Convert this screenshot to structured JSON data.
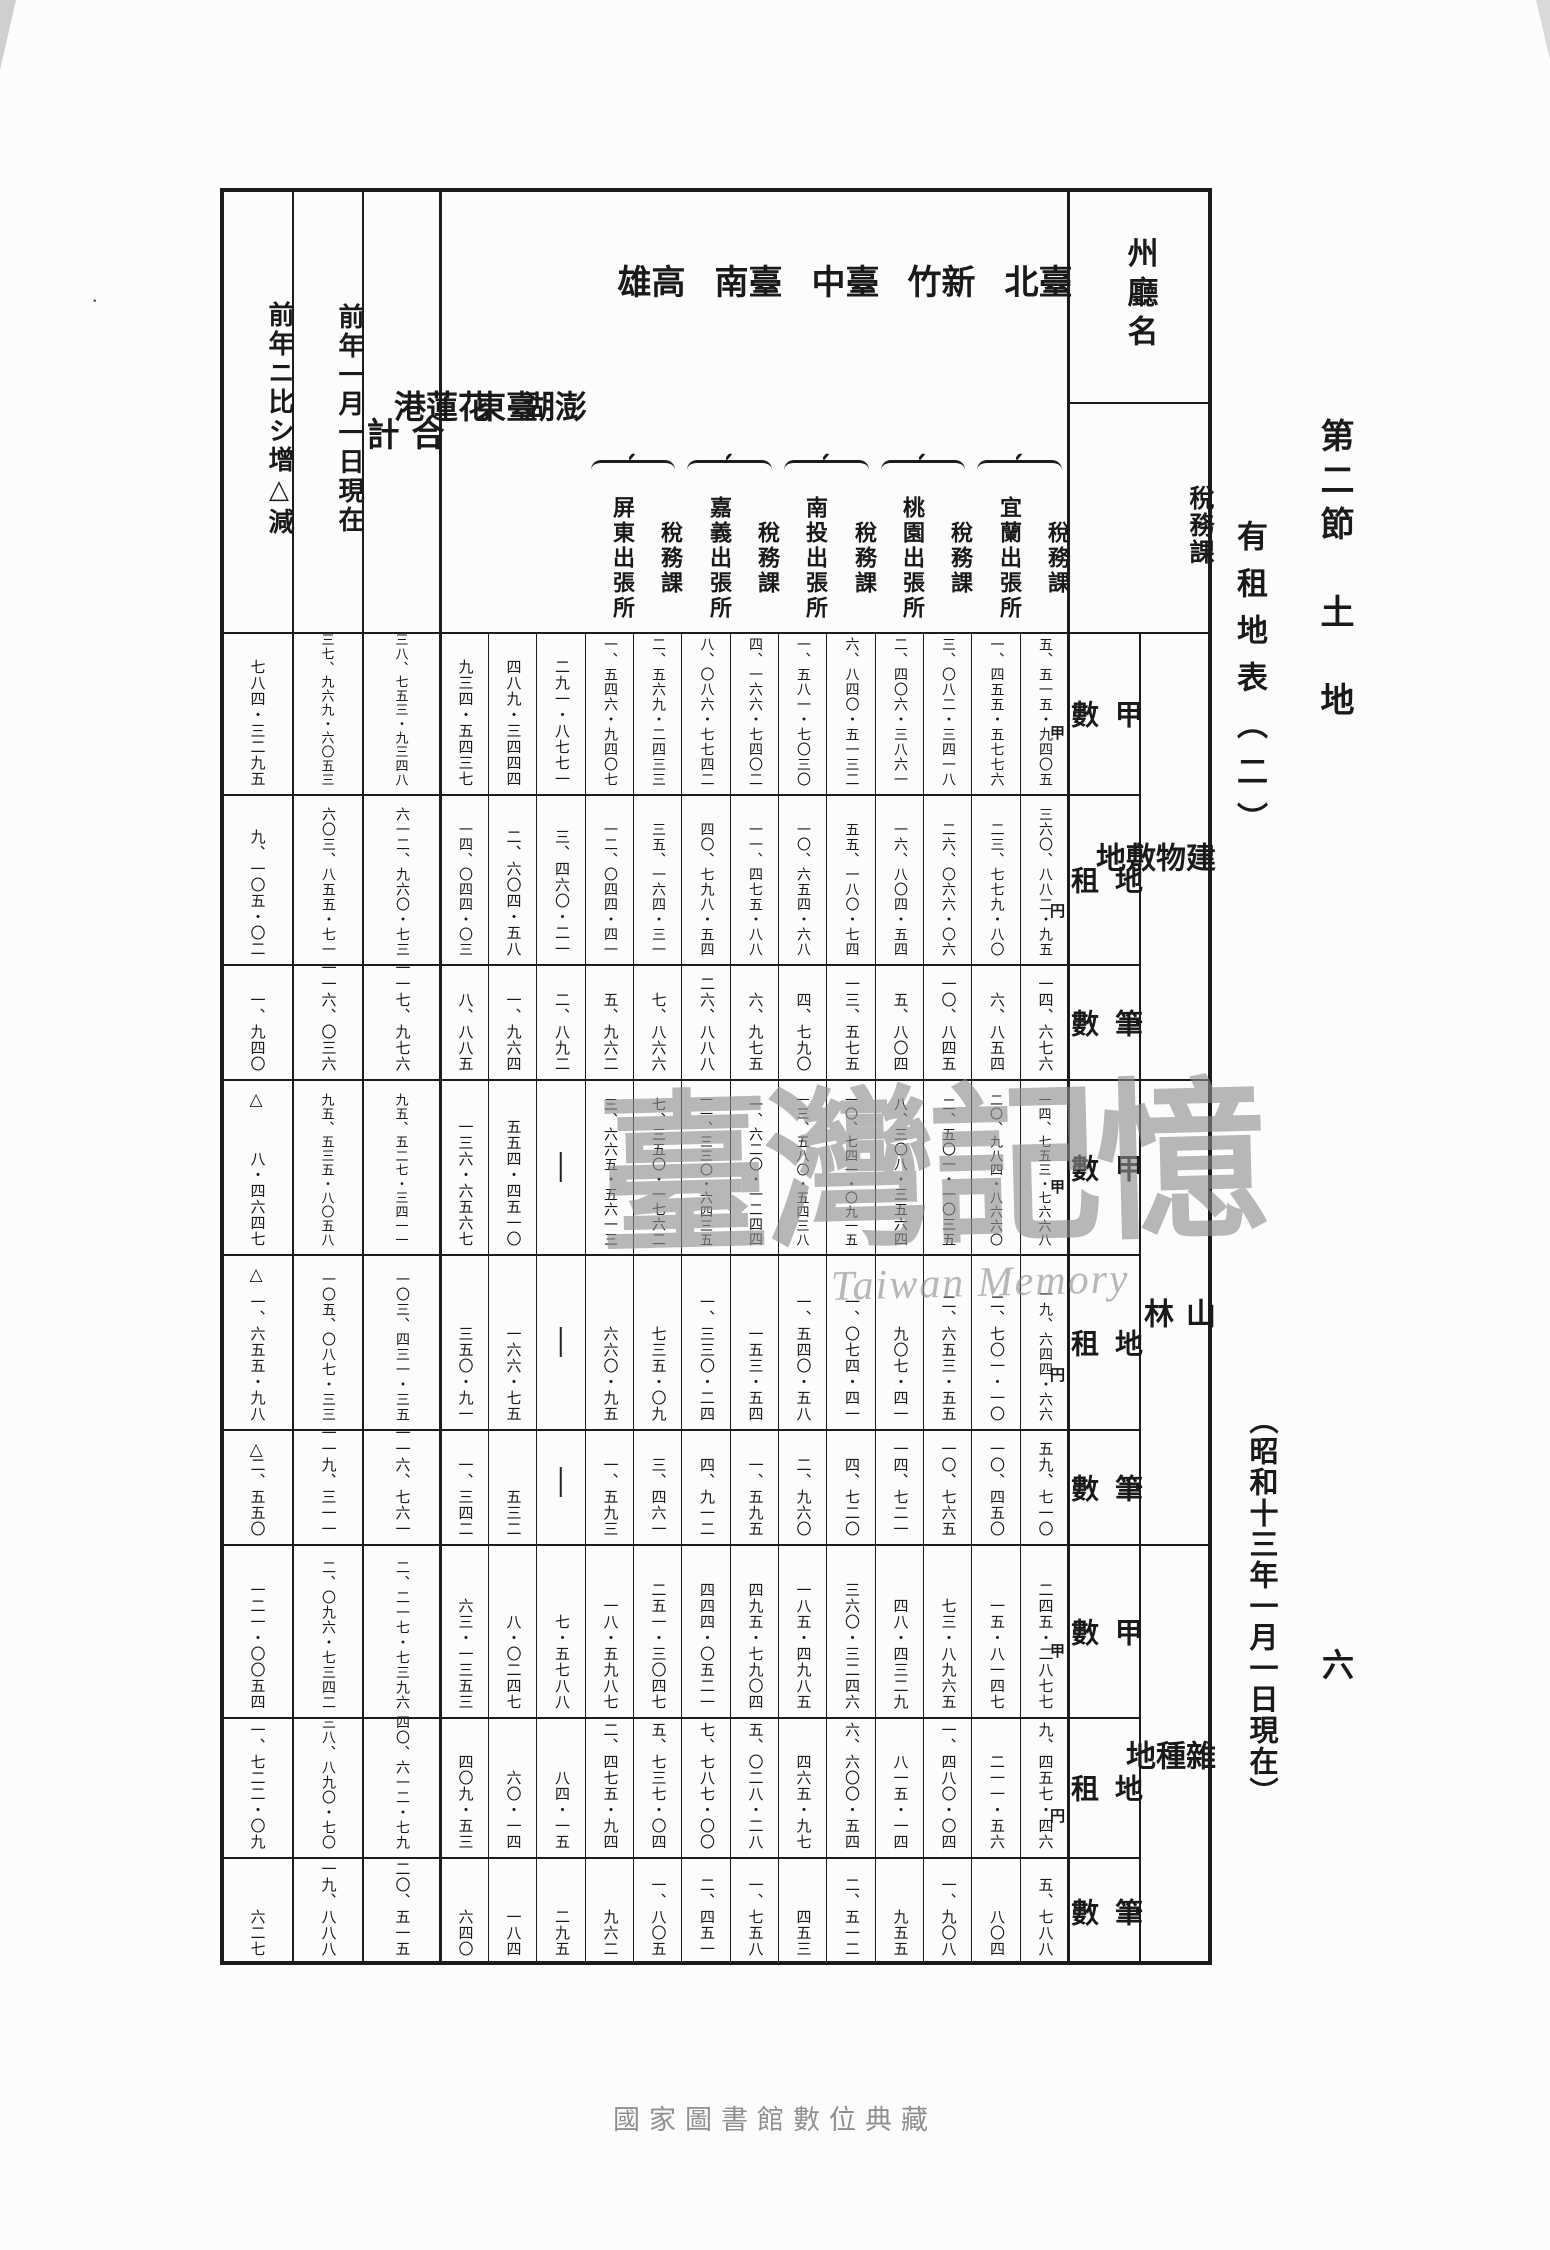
{
  "page_texts": {
    "section_title": "第二節　土　地",
    "table_title": "有租地表（二）",
    "date_note": "（昭和十三年一月一日現在）",
    "page_number": "六",
    "footer": "國家圖書館數位典藏",
    "watermark_main": "臺灣記憶",
    "watermark_sub": "Taiwan Memory",
    "stray_mark": "."
  },
  "table": {
    "corner_top": "州廳名",
    "corner_bottom_line1": "稅務課",
    "corner_bottom_line2": "稅務出張所別",
    "unit_area": "甲",
    "unit_rent": "円",
    "decrease_mark": "△",
    "dash": "—",
    "categories": [
      {
        "label": "建物敷地"
      },
      {
        "label": "山林"
      },
      {
        "label": "雜種地"
      }
    ],
    "measures": [
      "甲數",
      "地租",
      "筆數"
    ],
    "columns": [
      {
        "id": "zogen",
        "label": "前年ニ比シ增△減"
      },
      {
        "id": "zennen",
        "label": "前年一月一日現在"
      },
      {
        "id": "gokei",
        "label": "合計"
      },
      {
        "id": "karenko",
        "label": "花蓮港"
      },
      {
        "id": "taito",
        "label": "臺東"
      },
      {
        "id": "hoko",
        "label": "澎湖"
      },
      {
        "id": "heito",
        "group": "高雄",
        "sub": "屏東出張所"
      },
      {
        "id": "takao_zei",
        "group": "高雄",
        "sub": "稅務課"
      },
      {
        "id": "kagi",
        "group": "臺南",
        "sub": "嘉義出張所"
      },
      {
        "id": "tainan_zei",
        "group": "臺南",
        "sub": "稅務課"
      },
      {
        "id": "nanto",
        "group": "臺中",
        "sub": "南投出張所"
      },
      {
        "id": "taichu_zei",
        "group": "臺中",
        "sub": "稅務課"
      },
      {
        "id": "toen",
        "group": "新竹",
        "sub": "桃園出張所"
      },
      {
        "id": "shinchiku_zei",
        "group": "新竹",
        "sub": "稅務課"
      },
      {
        "id": "giran",
        "group": "臺北",
        "sub": "宜蘭出張所"
      },
      {
        "id": "taihoku_zei",
        "group": "臺北",
        "sub": "稅務課"
      }
    ],
    "header_groups": [
      {
        "label": "臺北",
        "type": "pair",
        "cols": [
          "giran",
          "taihoku_zei"
        ]
      },
      {
        "label": "新竹",
        "type": "pair",
        "cols": [
          "toen",
          "shinchiku_zei"
        ]
      },
      {
        "label": "臺中",
        "type": "pair",
        "cols": [
          "nanto",
          "taichu_zei"
        ]
      },
      {
        "label": "臺南",
        "type": "pair",
        "cols": [
          "kagi",
          "tainan_zei"
        ]
      },
      {
        "label": "高雄",
        "type": "pair",
        "cols": [
          "heito",
          "takao_zei"
        ]
      },
      {
        "label": "澎湖",
        "type": "spread",
        "cols": [
          "hoko"
        ]
      },
      {
        "label": "臺東",
        "type": "spread",
        "cols": [
          "taito"
        ]
      },
      {
        "label": "花蓮港",
        "type": "spread",
        "cols": [
          "karenko"
        ]
      },
      {
        "label": "合計",
        "type": "total",
        "cols": [
          "gokei"
        ]
      },
      {
        "label": "前年一月一日現在",
        "type": "full",
        "cols": [
          "zennen"
        ]
      },
      {
        "label": "前年ニ比シ增△減",
        "type": "full",
        "cols": [
          "zogen"
        ]
      }
    ],
    "bands": [
      {
        "category": 0,
        "measure": "甲數",
        "unit": "甲",
        "values": {
          "taihoku_zei": "五、五一五・九四〇五",
          "giran": "一、四五五・五七七六",
          "shinchiku_zei": "三、〇八二・三四一八",
          "toen": "二、四〇六・三八六一",
          "taichu_zei": "六、八四〇・五一三二",
          "nanto": "一、五八一・七〇三〇",
          "tainan_zei": "四、一六六・七四〇二",
          "kagi": "八、〇八六・七七四二",
          "takao_zei": "二、五六九・二四三三",
          "heito": "一、五四六・九四〇七",
          "hoko": "二九一・八七七一",
          "taito": "四八九・三四四四",
          "karenko": "九三四・五四三七",
          "gokei": "三八、七五三・九三四八",
          "zennen": "三七、九六九・六〇五三",
          "zogen": "七八四・三二九五"
        }
      },
      {
        "category": 0,
        "measure": "地租",
        "unit": "円",
        "values": {
          "taihoku_zei": "三六〇、八八二・九五",
          "giran": "二三、七七九・八〇",
          "shinchiku_zei": "二六、〇六六・〇六",
          "toen": "一六、八〇四・五四",
          "taichu_zei": "五五、一八〇・七四",
          "nanto": "一〇、六五四・六八",
          "tainan_zei": "一一、四七五・八八",
          "kagi": "四〇、七九八・五四",
          "takao_zei": "三五、一六四・三一",
          "heito": "一二、〇四四・四一",
          "hoko": "三、四六〇・二一",
          "taito": "二、六〇四・五八",
          "karenko": "一四、〇四四・〇三",
          "gokei": "六一二、九六〇・七三",
          "zennen": "六〇三、八五五・七一",
          "zogen": "九、一〇五・〇二"
        }
      },
      {
        "category": 0,
        "measure": "筆數",
        "unit": null,
        "values": {
          "taihoku_zei": "一四、六七六",
          "giran": "六、八五四",
          "shinchiku_zei": "一〇、八四五",
          "toen": "五、八〇四",
          "taichu_zei": "一三、五七五",
          "nanto": "四、七九〇",
          "tainan_zei": "六、九七五",
          "kagi": "二六、八八八",
          "takao_zei": "七、八六六",
          "heito": "五、九六二",
          "hoko": "二、八九二",
          "taito": "一、九六四",
          "karenko": "八、八八五",
          "gokei": "一一七、九七六",
          "zennen": "一一六、〇三六",
          "zogen": "一、九四〇"
        }
      },
      {
        "category": 1,
        "measure": "甲數",
        "unit": "甲",
        "values": {
          "taihoku_zei": "一四、七五三・七六六八",
          "giran": "二〇、九八四・八六六〇",
          "shinchiku_zei": "二、五〇一・一〇三五",
          "toen": "八、三〇八・三五六四",
          "taichu_zei": "一〇、七四一・〇九一五",
          "nanto": "一三、五八〇・五四三八",
          "tainan_zei": "一、六二〇・一二四四",
          "kagi": "一一、三三〇・六四三五",
          "takao_zei": "七、三五〇・一七六二",
          "heito": "三、六六五・五六一三",
          "hoko": "—",
          "taito": "五五四・四五一〇",
          "karenko": "一三六・六五六七",
          "gokei": "九五、五二七・三四一一",
          "zennen": "九五、五三五・八〇五八",
          "zogen": "△八・四六四七"
        }
      },
      {
        "category": 1,
        "measure": "地租",
        "unit": "円",
        "values": {
          "taihoku_zei": "一九、六四四・六六",
          "giran": "二、七〇一・一〇",
          "shinchiku_zei": "二、六五三・五五",
          "toen": "九〇七・四一",
          "taichu_zei": "一、〇七四・四一",
          "nanto": "一、五四〇・五八",
          "tainan_zei": "一五三・五四",
          "kagi": "一、三三〇・二四",
          "takao_zei": "七三五・〇九",
          "heito": "六六〇・九五",
          "hoko": "—",
          "taito": "一六六・七五",
          "karenko": "三五〇・九一",
          "gokei": "一〇三、四三一・三五",
          "zennen": "一〇五、〇八七・三三",
          "zogen": "△一、六五五・九八"
        }
      },
      {
        "category": 1,
        "measure": "筆數",
        "unit": null,
        "values": {
          "taihoku_zei": "五九、七一〇",
          "giran": "一〇、四五〇",
          "shinchiku_zei": "一〇、七六五",
          "toen": "一四、七二一",
          "taichu_zei": "四、七二〇",
          "nanto": "二、九六〇",
          "tainan_zei": "一、五九五",
          "kagi": "四、九一二",
          "takao_zei": "三、四六一",
          "heito": "一、五九三",
          "hoko": "—",
          "taito": "五三二",
          "karenko": "一、三四二",
          "gokei": "一一六、七六一",
          "zennen": "一一九、三一一",
          "zogen": "△二、五五〇"
        }
      },
      {
        "category": 2,
        "measure": "甲數",
        "unit": "甲",
        "values": {
          "taihoku_zei": "二四五・二八七七",
          "giran": "一五・八一四七",
          "shinchiku_zei": "七三・八九六五",
          "toen": "四八・四三二九",
          "taichu_zei": "三六〇・三二四六",
          "nanto": "一八五・四九八五",
          "tainan_zei": "四九五・七九〇四",
          "kagi": "四四四・〇五二一",
          "takao_zei": "二五一・三〇四七",
          "heito": "一八・五九八七",
          "hoko": "七・五七八八",
          "taito": "八・〇二四七",
          "karenko": "六三・一三五三",
          "gokei": "二、二一七・七三九六",
          "zennen": "二、〇九六・七三四二",
          "zogen": "一二一・〇〇五四"
        }
      },
      {
        "category": 2,
        "measure": "地租",
        "unit": "円",
        "values": {
          "taihoku_zei": "九、四五七・四六",
          "giran": "二一一・五六",
          "shinchiku_zei": "一、四八〇・〇四",
          "toen": "八一五・一四",
          "taichu_zei": "六、六〇〇・五四",
          "nanto": "四六五・九七",
          "tainan_zei": "五、〇二八・二八",
          "kagi": "七、七八七・〇〇",
          "takao_zei": "五、七三七・〇四",
          "heito": "二、四七五・九四",
          "hoko": "八四・一五",
          "taito": "六〇・一四",
          "karenko": "四〇九・五三",
          "gokei": "四〇、六一二・七九",
          "zennen": "三八、八九〇・七〇",
          "zogen": "一、七二二・〇九"
        }
      },
      {
        "category": 2,
        "measure": "筆數",
        "unit": null,
        "values": {
          "taihoku_zei": "五、七八八",
          "giran": "八〇四",
          "shinchiku_zei": "一、九〇八",
          "toen": "九五五",
          "taichu_zei": "二、五一二",
          "nanto": "四五三",
          "tainan_zei": "一、七五八",
          "kagi": "二、四五一",
          "takao_zei": "一、八〇五",
          "heito": "九六二",
          "hoko": "二九五",
          "taito": "一八四",
          "karenko": "六四〇",
          "gokei": "二〇、五一五",
          "zennen": "一九、八八八",
          "zogen": "六二七"
        }
      }
    ]
  }
}
